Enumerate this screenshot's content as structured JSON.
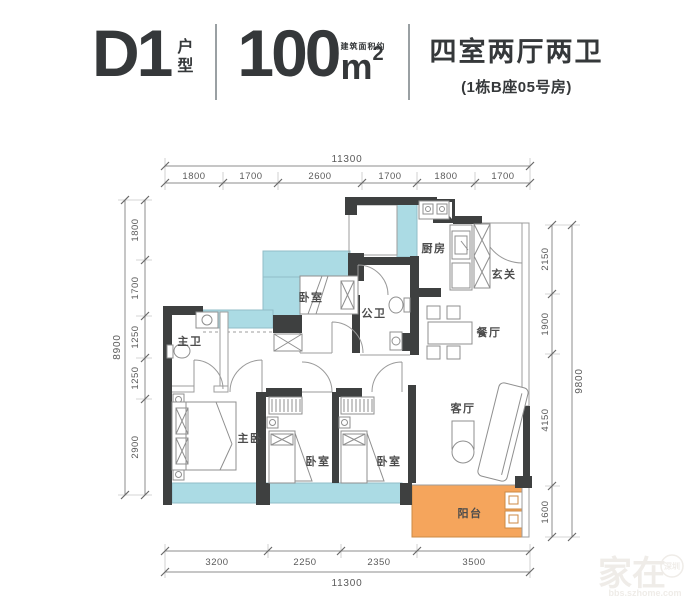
{
  "header": {
    "unit_code": "D1",
    "unit_code_label": "户型",
    "area_value": "100",
    "area_prefix": "建筑面积约",
    "area_unit": "m",
    "area_sup": "2",
    "layout_title": "四室两厅两卫",
    "layout_subtitle": "(1栋B座05号房)"
  },
  "rooms": {
    "master_bath": "主卫",
    "bedroom_top": "卧室",
    "kitchen": "厨房",
    "foyer": "玄关",
    "public_bath": "公卫",
    "dining": "餐厅",
    "master_bedroom": "主卧",
    "bedroom_left": "卧室",
    "bedroom_right": "卧室",
    "living": "客厅",
    "balcony": "阳台"
  },
  "dimensions": {
    "top": {
      "total": "11300",
      "segments": [
        "1800",
        "1700",
        "2600",
        "1700",
        "1800",
        "1700"
      ]
    },
    "bottom": {
      "total": "11300",
      "segments": [
        "3200",
        "2250",
        "2350",
        "3500"
      ]
    },
    "left": {
      "total": "8900",
      "segments": [
        "1800",
        "1700",
        "1250",
        "1250",
        "2900"
      ]
    },
    "right": {
      "total": "9800",
      "segments": [
        "2150",
        "1900",
        "4150",
        "1600"
      ]
    }
  },
  "watermark": {
    "brand": "家在",
    "badge": "深圳",
    "site": "bbs.szhome.com"
  },
  "colors": {
    "wall": "#3e4040",
    "window": "#abdbe4",
    "balcony": "#f5a55c",
    "line": "#8c8c8c",
    "dim": "#5a5a5a",
    "text": "#35383a"
  }
}
